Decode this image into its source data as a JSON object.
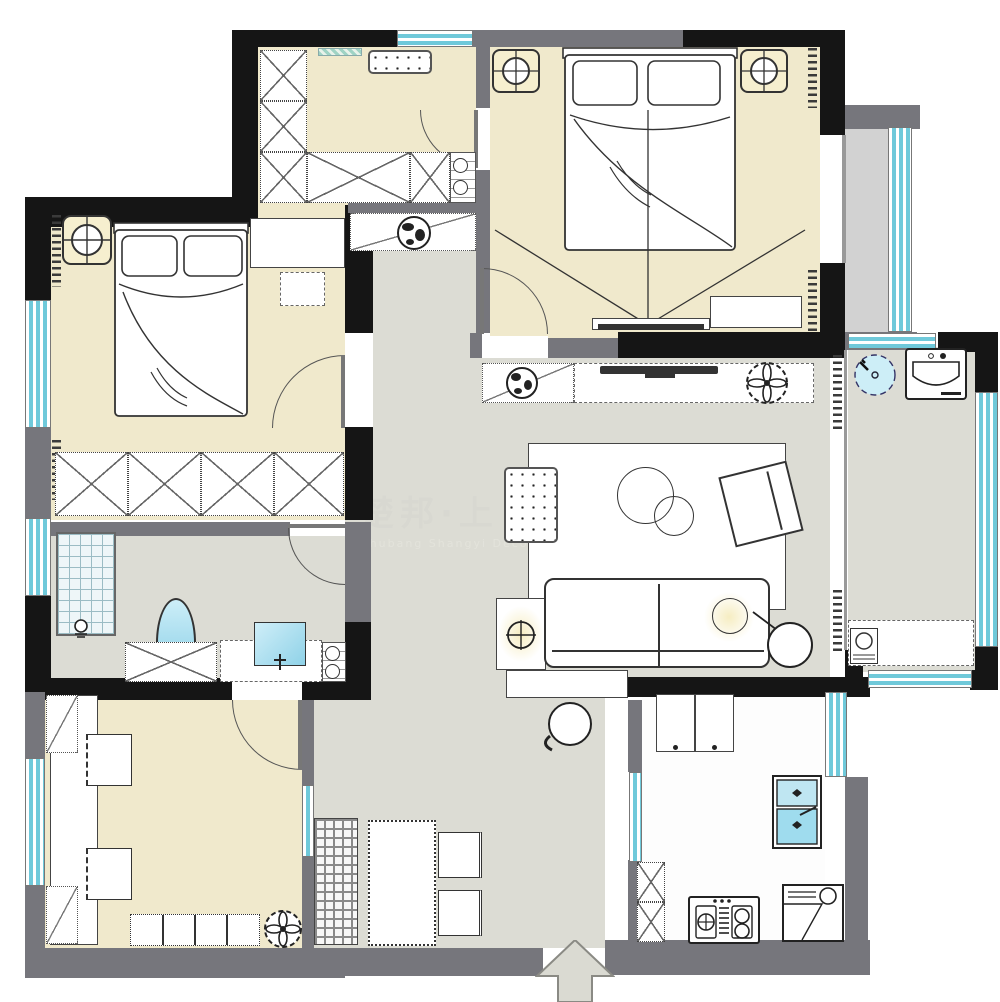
{
  "watermark": {
    "line1": "楚邦·上",
    "line2": "Chubang Shangyi Deco"
  },
  "palette": {
    "floor_beige": "#f0e9cc",
    "floor_gray": "#dcdcd4",
    "floor_balcony": "#d2d2d2",
    "wall_black": "#151515",
    "wall_gray": "#76767c",
    "window_cyan": "#6fc9da",
    "fixture_blue": "#a8dcec",
    "lamp_glow": "#f6edc2",
    "line": "#555555",
    "watermark_color": "#d8d8d1"
  }
}
